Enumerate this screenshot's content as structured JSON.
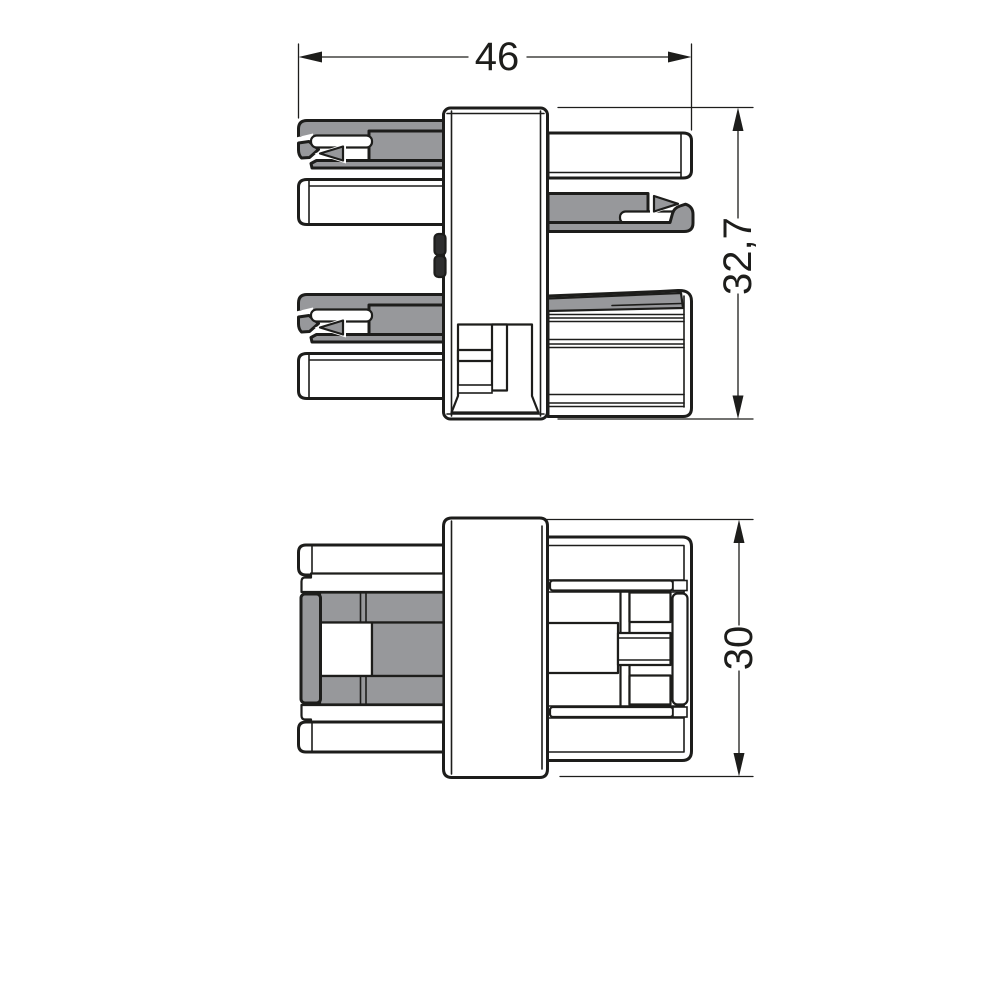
{
  "drawing": {
    "title": "connector-technical-drawing",
    "views": {
      "side_view": "side-elevation-with-contacts",
      "plan_view": "plan-view"
    },
    "dimensions": {
      "width_label": "46",
      "side_height_label": "32,7",
      "plan_height_label": "30"
    },
    "colors": {
      "line": "#1d1d1b",
      "fill_gray": "#97989b",
      "background": "#ffffff"
    }
  }
}
